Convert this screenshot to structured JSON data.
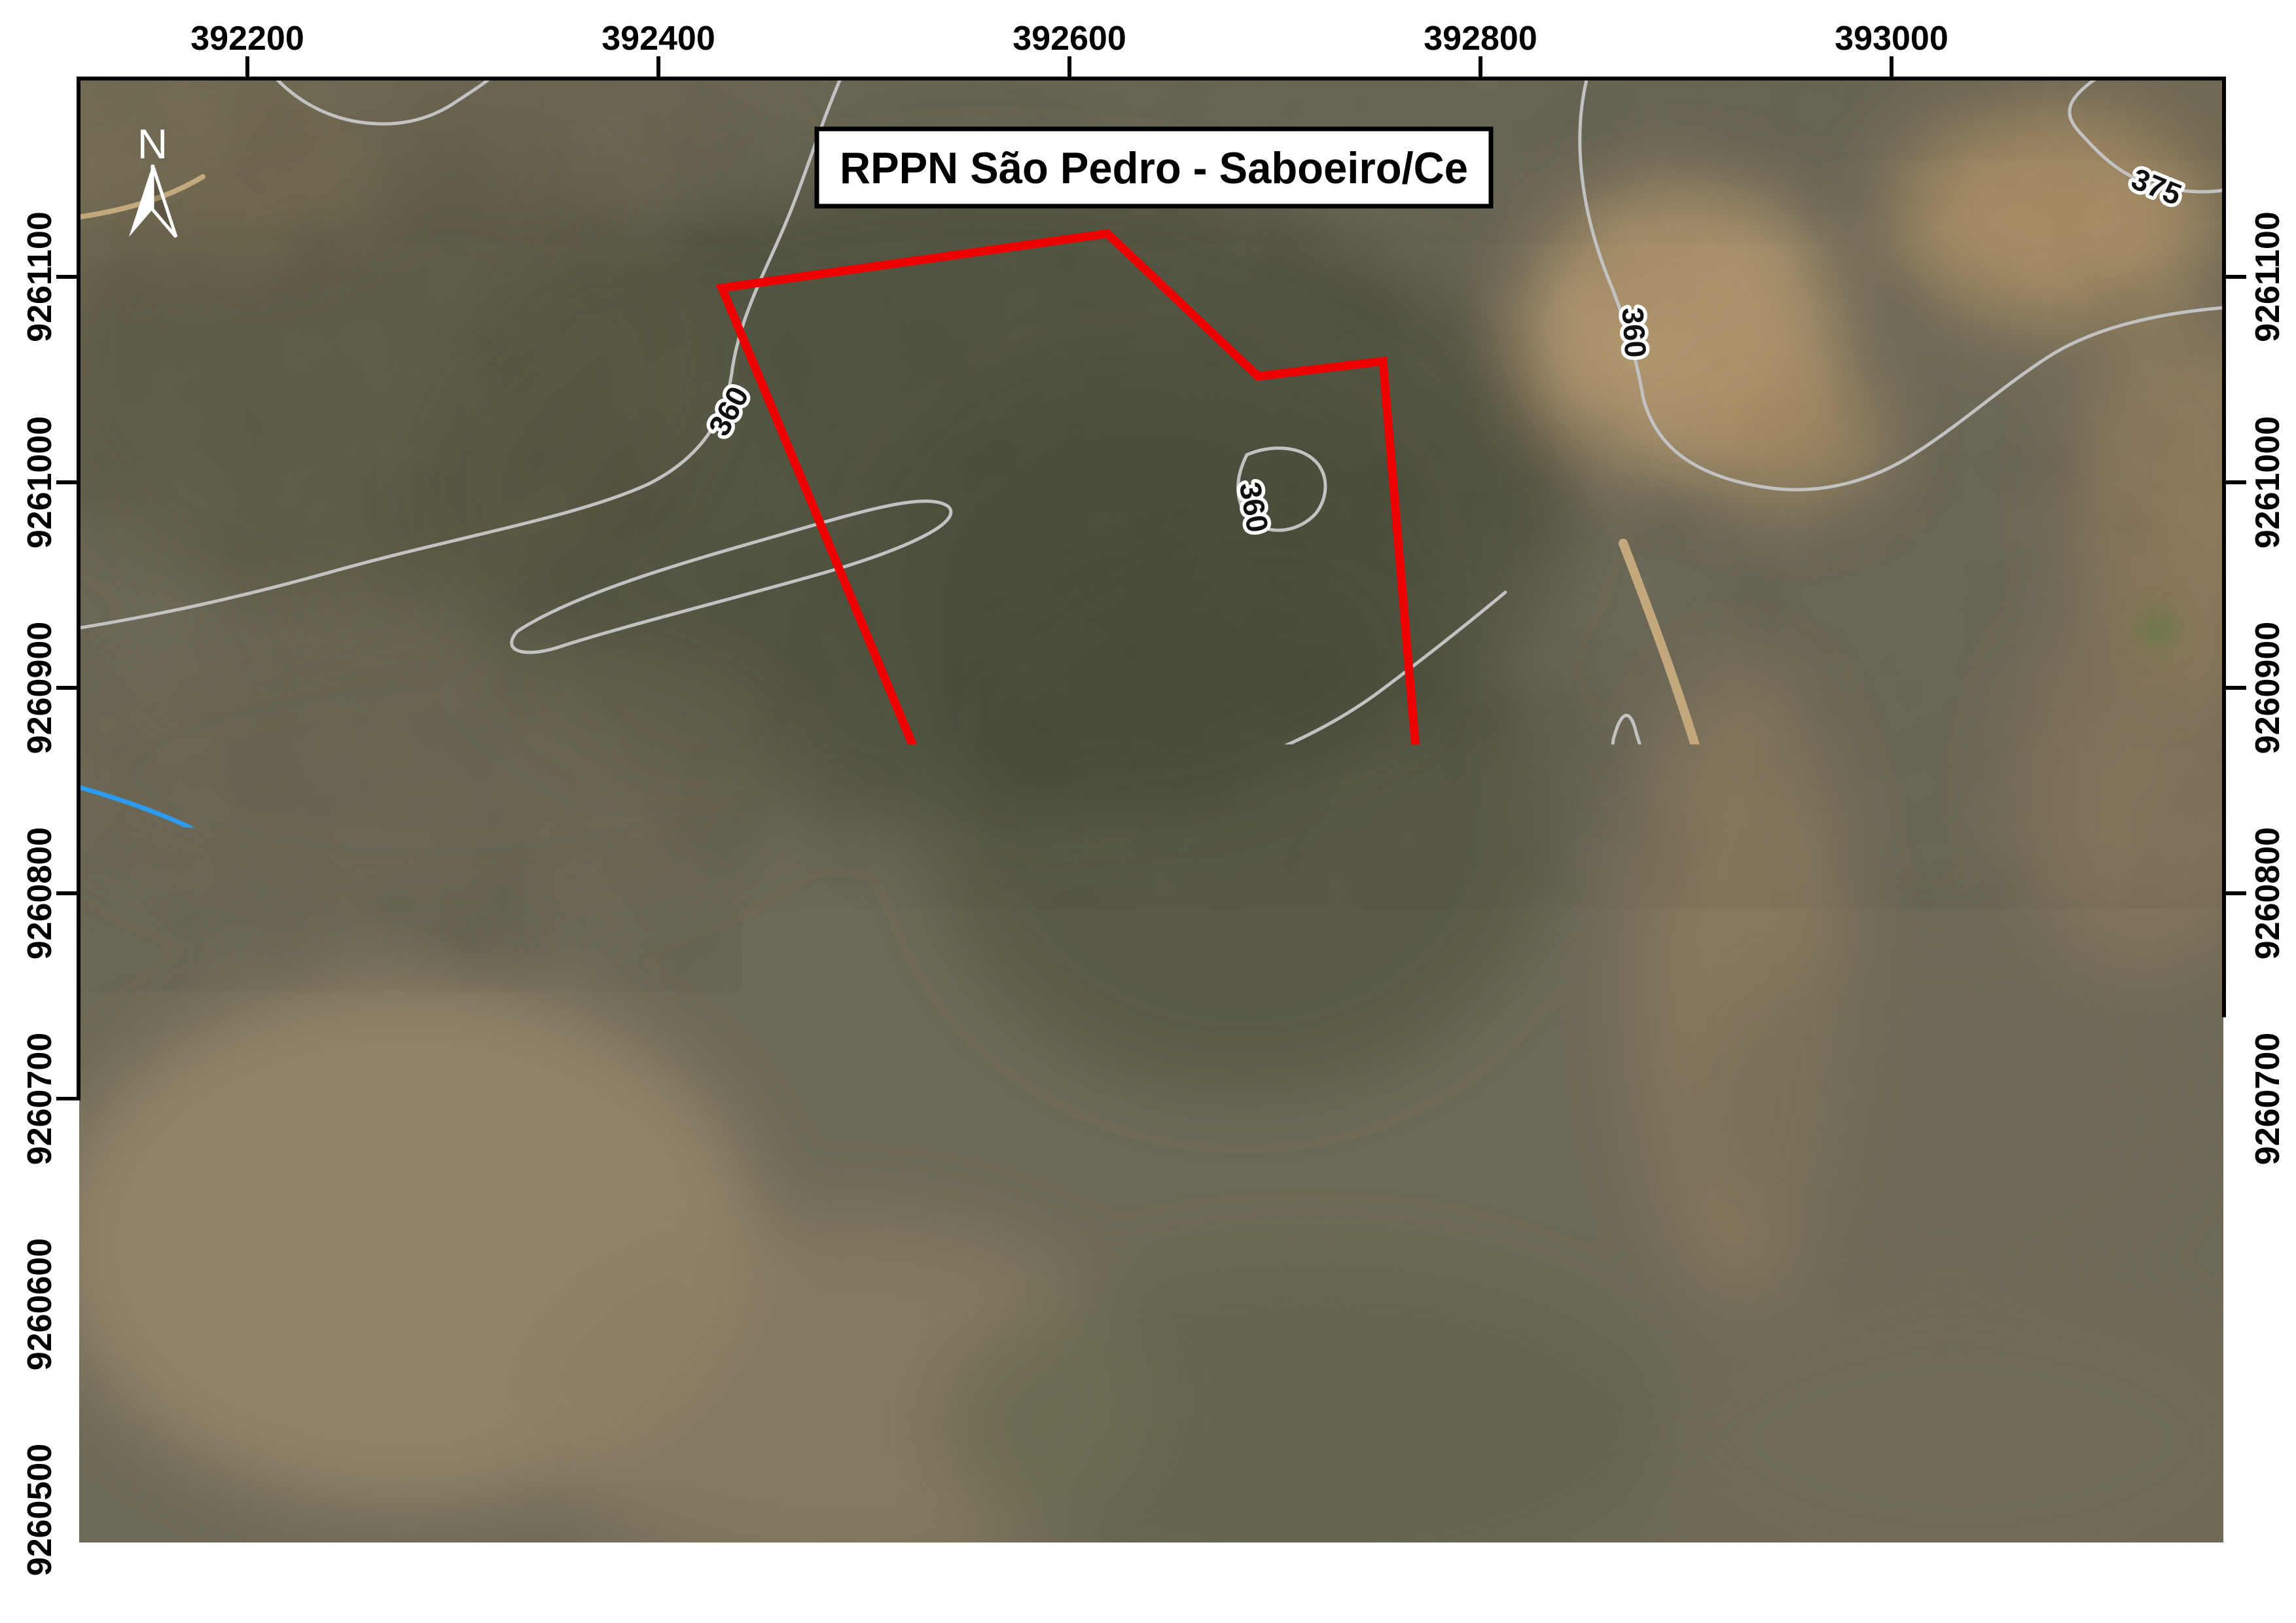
{
  "map_title": {
    "text": "RPPN São Pedro - Saboeiro/Ce"
  },
  "north_arrow": {
    "label": "N"
  },
  "grid": {
    "top": [
      {
        "label": "392200"
      },
      {
        "label": "392400"
      },
      {
        "label": "392600"
      },
      {
        "label": "392800"
      },
      {
        "label": "393000"
      }
    ],
    "bottom": [
      {
        "label": "392200"
      },
      {
        "label": "392400"
      },
      {
        "label": "392600"
      },
      {
        "label": "392800"
      },
      {
        "label": "393000"
      }
    ],
    "left": [
      {
        "label": "9261100"
      },
      {
        "label": "9261000"
      },
      {
        "label": "9260900"
      },
      {
        "label": "9260800"
      },
      {
        "label": "9260700"
      },
      {
        "label": "9260600"
      },
      {
        "label": "9260500"
      }
    ],
    "right": [
      {
        "label": "9261100"
      },
      {
        "label": "9261000"
      },
      {
        "label": "9260900"
      },
      {
        "label": "9260800"
      },
      {
        "label": "9260700"
      },
      {
        "label": "9260600"
      },
      {
        "label": "9260500"
      }
    ]
  },
  "scale_bar": {
    "tick_labels": [
      "0",
      "35",
      "70",
      "140",
      "210"
    ],
    "unit": "m"
  },
  "contour_labels": [
    {
      "value": "360"
    },
    {
      "value": "360"
    },
    {
      "value": "360"
    },
    {
      "value": "345"
    },
    {
      "value": "330"
    },
    {
      "value": "345"
    },
    {
      "value": "375"
    }
  ],
  "boundary": {
    "name": "RPPN São Pedro boundary",
    "color": "#ee0000",
    "vertices_utm": [
      {
        "e": 392431,
        "n": 9261095
      },
      {
        "e": 392618,
        "n": 9261121
      },
      {
        "e": 392692,
        "n": 9261052
      },
      {
        "e": 392753,
        "n": 9261059
      },
      {
        "e": 392774,
        "n": 9260806
      },
      {
        "e": 392606,
        "n": 9260674
      }
    ]
  },
  "attribution": {
    "line1": "Esri, HERE, Garmin, © OpenStreetMap contributors, and the GIS user community;  Source: Esri, DigitalGlobe,",
    "line2": "GeoEye, Earthstar Geographics, CNES/Airbus DS, USDA, USGS, AeroGRID, IGN, and the GIS User",
    "line3": "Community"
  },
  "colors": {
    "boundary": "#ee0000",
    "stream": "#2d9bf0",
    "contour": "#c2c2c2",
    "track_road": "#f4f2ec",
    "dirt_road": "#c4a87d",
    "frame": "#000000"
  }
}
